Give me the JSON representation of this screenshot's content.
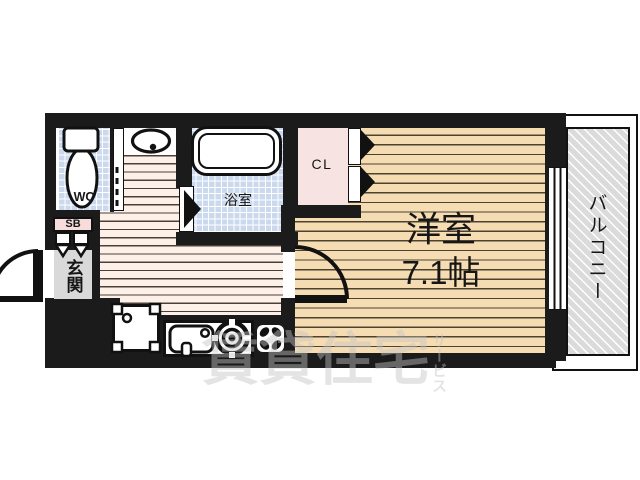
{
  "floorplan": {
    "rooms": {
      "wc": "WC",
      "bath": "浴室",
      "closet": "CL",
      "western": "洋室",
      "western_size": "7.1帖",
      "balcony": "バルコニー",
      "entrance": "玄関",
      "shoebox": "SB"
    },
    "watermark": {
      "main": "賃貸住宅",
      "sub": "サービス"
    },
    "fixtures": [
      "toilet",
      "washbasin",
      "bathtub",
      "washing-machine",
      "kitchen-sink",
      "gas-stove",
      "ventilation-fan",
      "sliding-window",
      "entrance-door",
      "room-door",
      "wc-folding-door",
      "closet-doors",
      "shoebox-doors"
    ],
    "colors": {
      "wall": "#1b1b1b",
      "tile_blue": "#cbd9ee",
      "wood_light": "#fdf0e8",
      "wood_tan": "#f6dcb2",
      "closet_pink": "#f7e4e2",
      "shoebox_pink": "#f8dcdc",
      "entrance_gray": "#d9d9d9",
      "balcony_gray": "#dbdbdb"
    }
  }
}
